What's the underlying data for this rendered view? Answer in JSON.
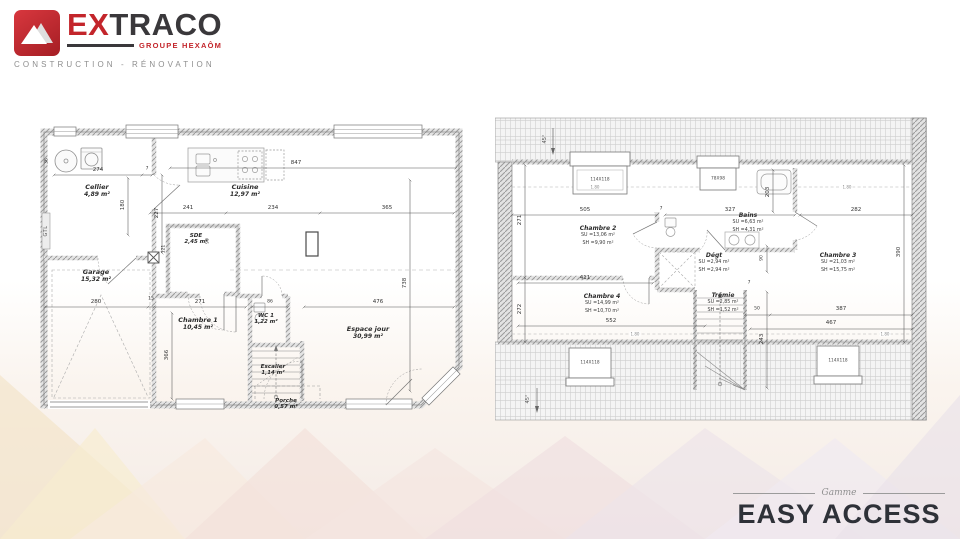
{
  "logo": {
    "brand_prefix": "EX",
    "brand_suffix": "TRACO",
    "group_line": "GROUPE HEXAÔM",
    "tagline": "CONSTRUCTION - RÉNOVATION",
    "accent_color": "#c3252b"
  },
  "footer": {
    "range_label": "Gamme",
    "range_name": "EASY ACCESS"
  },
  "ground_floor": {
    "rooms": {
      "cellier": {
        "name": "Cellier",
        "area": "4,89 m²"
      },
      "cuisine": {
        "name": "Cuisine",
        "area": "12,97 m²"
      },
      "sde": {
        "name": "SDE",
        "area": "2,45 m²"
      },
      "garage": {
        "name": "Garage",
        "area": "15,32 m²"
      },
      "chambre1": {
        "name": "Chambre 1",
        "area": "10,45 m²"
      },
      "wc1": {
        "name": "WC 1",
        "area": "1,22 m²"
      },
      "espace_jour": {
        "name": "Espace jour",
        "area": "30,99 m²"
      },
      "escalier": {
        "name": "Escalier",
        "area": "1,14 m²"
      },
      "porche": {
        "name": "Porche",
        "area": "0,57 m²"
      }
    },
    "annotations": {
      "gtl": "GTL"
    },
    "dims": {
      "d274": "274",
      "d180": "180",
      "d227": "227",
      "d847": "847",
      "d241": "241",
      "d234": "234",
      "d365": "365",
      "d738": "738",
      "d280": "280",
      "d15": "15",
      "d271": "271",
      "d366": "366",
      "d86": "86",
      "d476": "476",
      "d121": "121",
      "d90": "90",
      "d36": "36",
      "d7": "7"
    }
  },
  "first_floor": {
    "rooms": {
      "chambre2": {
        "name": "Chambre 2",
        "su": "SU =13,06 m²",
        "sh": "SH =9,90 m²"
      },
      "bains": {
        "name": "Bains",
        "su": "SU =6,63 m²",
        "sh": "SH =4,31 m²"
      },
      "degt": {
        "name": "Dégt",
        "su": "SU =2,94 m²",
        "sh": "SH =2,94 m²"
      },
      "chambre3": {
        "name": "Chambre 3",
        "su": "SU =21,03 m²",
        "sh": "SH =15,75 m²"
      },
      "chambre4": {
        "name": "Chambre 4",
        "su": "SU =14,99 m²",
        "sh": "SH =10,70 m²"
      },
      "tremie": {
        "name": "Trémie",
        "su": "SU =2,85 m²",
        "sh": "SH =1,52 m²"
      }
    },
    "windows": {
      "w1": "114X118",
      "w2": "78X98",
      "w3": "114X118",
      "w4": "114X118"
    },
    "annotations": {
      "angle": "45°",
      "height_line": "1.80"
    },
    "dims": {
      "d505": "505",
      "d271": "271",
      "d272": "272",
      "d327": "327",
      "d203": "203",
      "d282": "282",
      "d411": "411",
      "d552": "552",
      "d90": "90",
      "d50": "50",
      "d243": "243",
      "d387": "387",
      "d467": "467",
      "d390": "390",
      "d7": "7"
    }
  }
}
